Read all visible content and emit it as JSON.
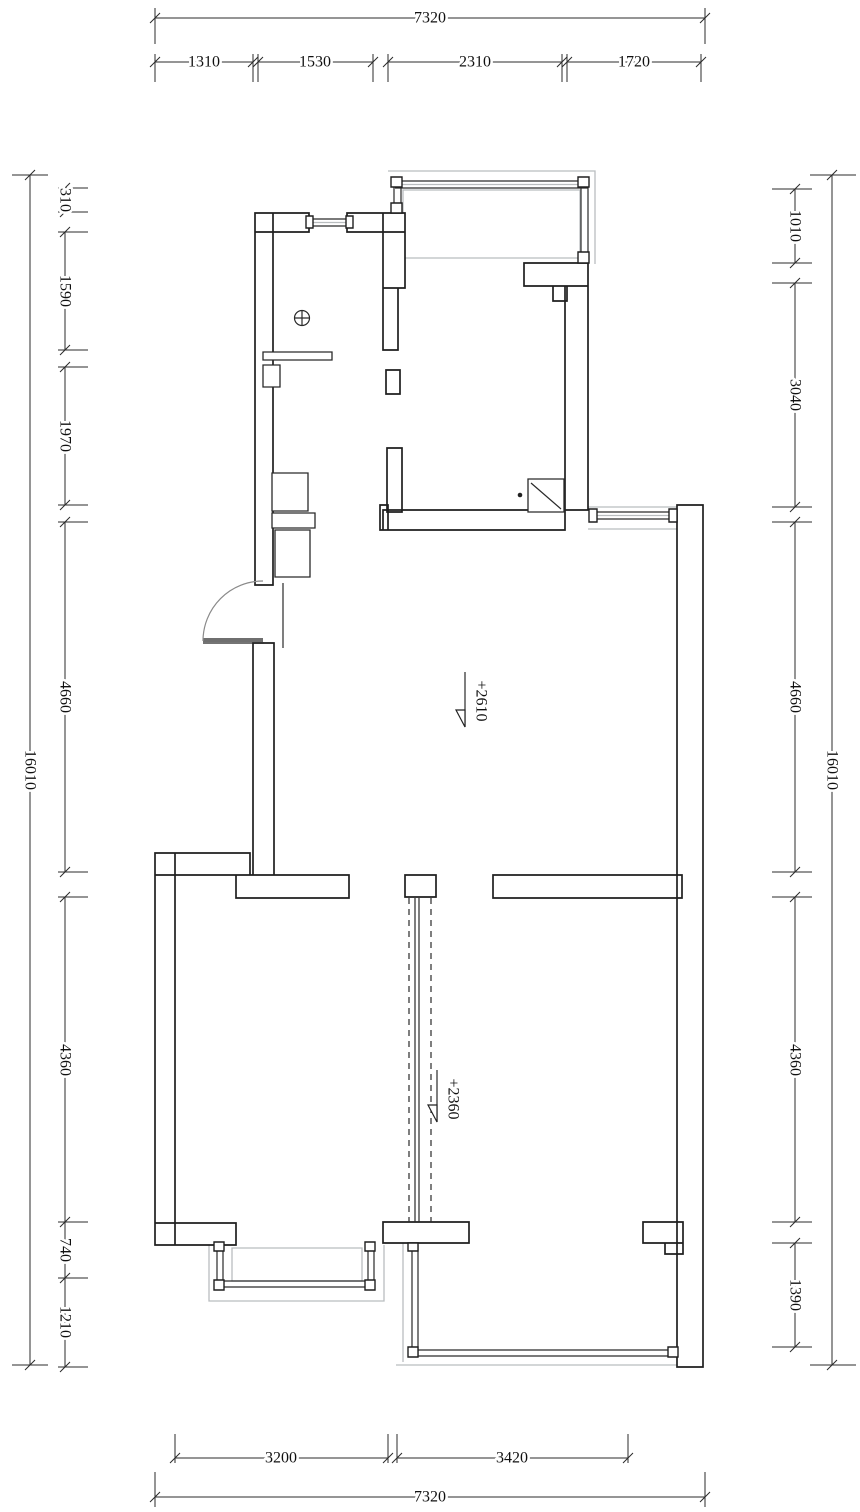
{
  "colors": {
    "wall_line": "#1f1f1f",
    "dimension_line": "#2b2b2b",
    "window_gray": "#b9bdbf",
    "text": "#101010",
    "background": "#ffffff"
  },
  "dimensions": {
    "top": {
      "overall": "7320",
      "segments": [
        "1310",
        "1530",
        "2310",
        "1720"
      ]
    },
    "bottom": {
      "overall": "7320",
      "segments": [
        "3200",
        "3420"
      ]
    },
    "left": {
      "overall": "16010",
      "segments": [
        "310",
        "1590",
        "1970",
        "4660",
        "4360",
        "740",
        "1210"
      ]
    },
    "right": {
      "overall": "16010",
      "segments": [
        "1010",
        "3040",
        "4660",
        "4360",
        "1390"
      ]
    }
  },
  "annotations": {
    "level_marks": [
      "+2610",
      "+2360"
    ]
  },
  "icons": {
    "floor_drain": "floor-drain-icon",
    "door_swing": "door-swing-arc",
    "level_flag": "elevation-flag-icon"
  }
}
